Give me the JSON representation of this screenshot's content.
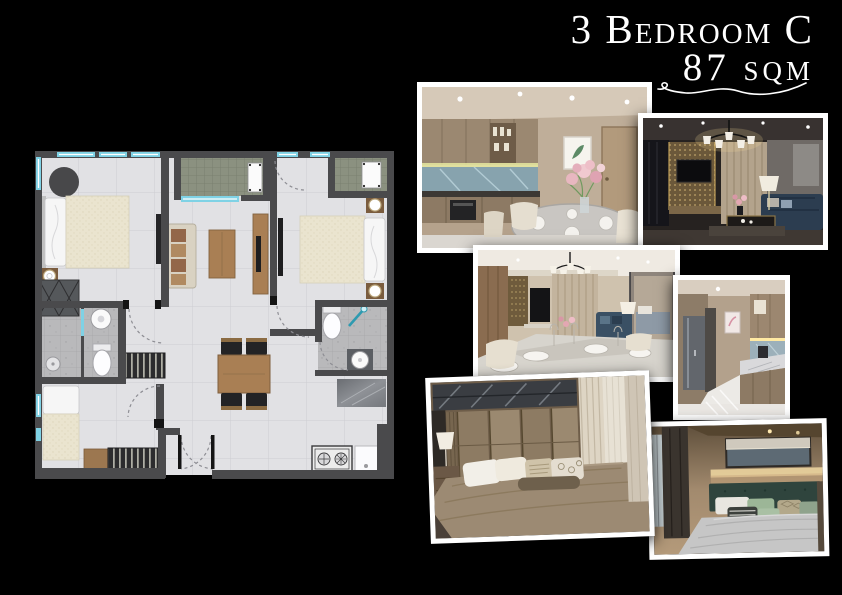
{
  "title": {
    "line1": "3 Bedroom C",
    "line2": "87 sqm"
  },
  "palette": {
    "background": "#000000",
    "title_text": "#ffffff",
    "photo_frame": "#ffffff",
    "plan_wall": "#4a4a4c",
    "plan_floor": "#e1e1e4",
    "plan_window_glass": "#7fd2e5",
    "plan_balcony_tile": "#8b9180",
    "plan_wood": "#a97f54",
    "plan_bathroom_tile": "#b9b9bb"
  },
  "floor_plan": {
    "name": "3-bedroom-type-c-floor-plan"
  },
  "photos": [
    {
      "name": "kitchen-and-dining-photo"
    },
    {
      "name": "living-room-photo"
    },
    {
      "name": "dining-and-living-photo"
    },
    {
      "name": "kitchen-corridor-photo"
    },
    {
      "name": "master-bedroom-photo"
    },
    {
      "name": "second-bedroom-photo"
    }
  ]
}
